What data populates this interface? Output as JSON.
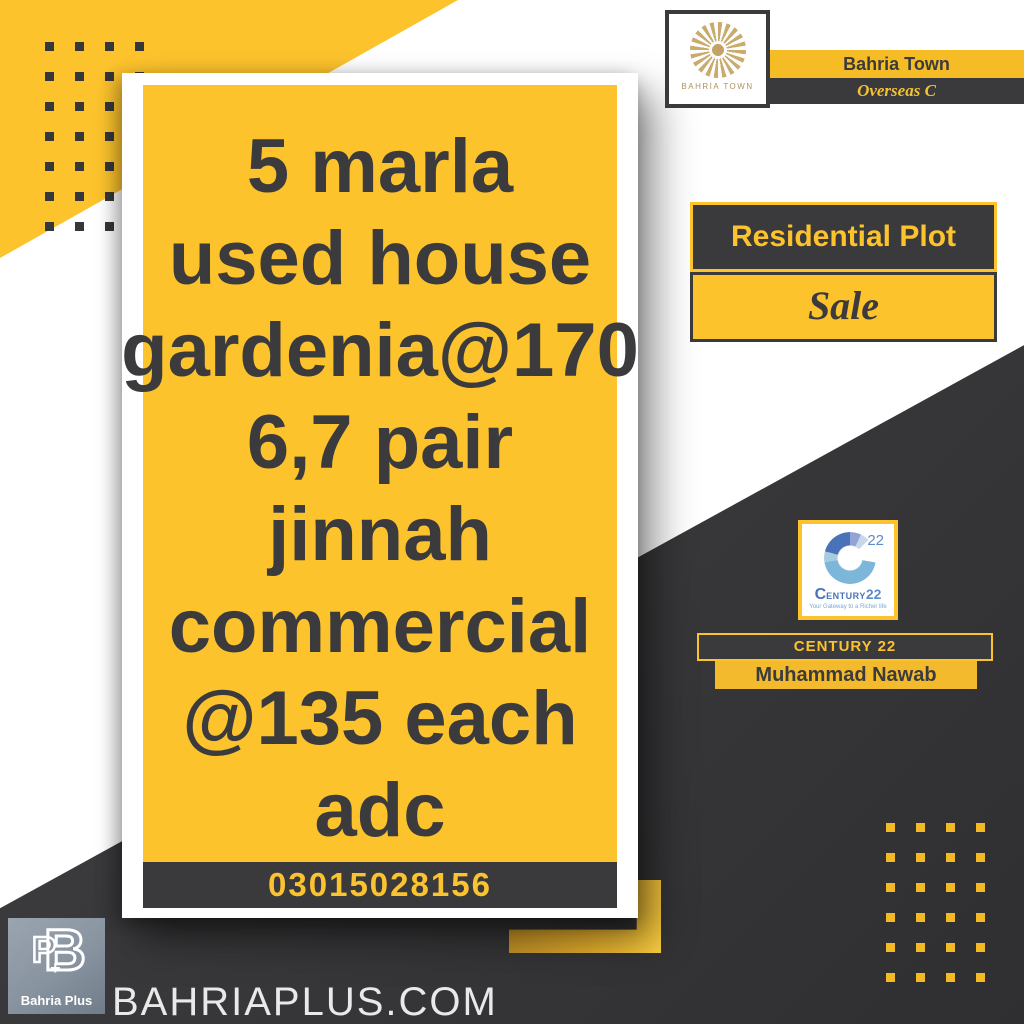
{
  "poster": {
    "card": {
      "listing_text": "5 marla\nused house\ngardenia@170\n6,7 pair\njinnah\ncommercial\n@135 each\nadc",
      "phone": "03015028156"
    },
    "bahria_town": {
      "logo_caption": "BAHRIA TOWN",
      "name": "Bahria Town",
      "phase": "Overseas C"
    },
    "listing": {
      "category": "Residential Plot",
      "status": "Sale"
    },
    "agency": {
      "logo_number": "22",
      "wordmark_c": "C",
      "wordmark_mid": "ENTURY",
      "wordmark_num": "22",
      "tagline": "Your Gateway to a Richer life",
      "name": "CENTURY 22",
      "agent": "Muhammad Nawab"
    },
    "branding": {
      "monogram_b": "B",
      "monogram_p": "P",
      "monogram_plus": "+",
      "logo_label": "Bahria Plus",
      "website": "BAHRIAPLUS.COM"
    }
  },
  "colors": {
    "accent_yellow": "#fcc32d",
    "dark": "#3a3a3c",
    "text_dark": "#3b3b3d",
    "gold": "#bfa065",
    "century_blue": "#4a72b8",
    "white": "#ffffff"
  }
}
